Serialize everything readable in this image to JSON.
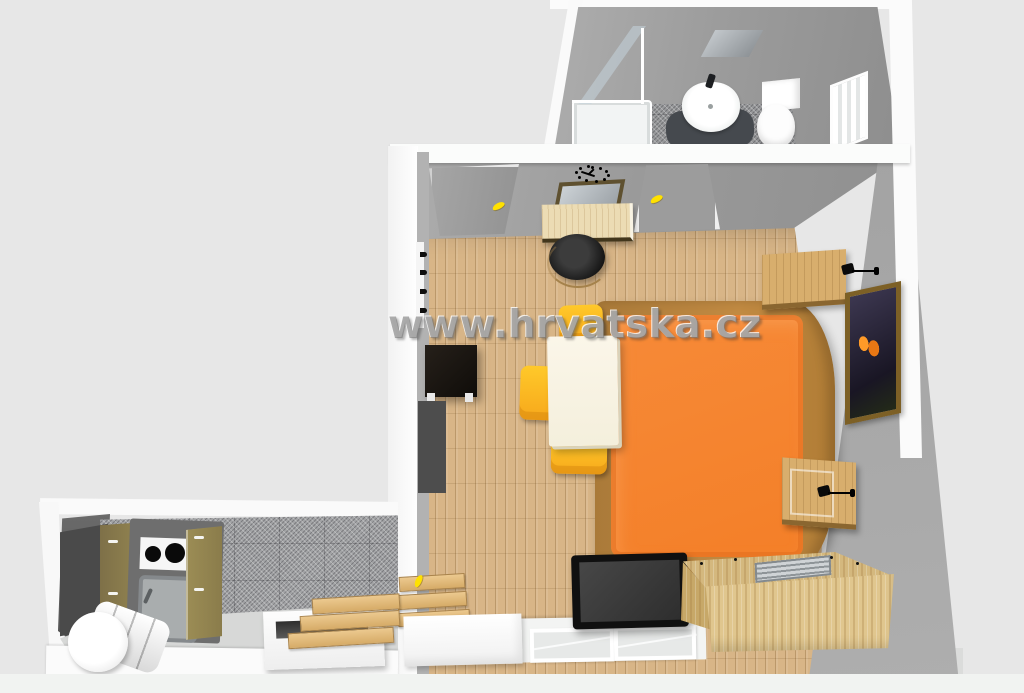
{
  "watermark": {
    "text": "www.hrvatska.cz"
  },
  "scene": {
    "type": "3d-apartment-floorplan-render",
    "view": "top-down perspective",
    "rooms": [
      {
        "name": "bathroom",
        "position": "top",
        "floor": "grey-speckled-tile",
        "fixtures": [
          "shower-cabin-glass",
          "shower-tray",
          "washbasin",
          "faucet",
          "dark-bath-mat",
          "toilet",
          "ceiling-mirror",
          "window"
        ]
      },
      {
        "name": "living-bedroom",
        "position": "center-right",
        "floor": "light-wood-parquet",
        "furniture": [
          "entry-door-grey-yellow-handle",
          "bathroom-door-grey-yellow-handle",
          "wall-clock-black",
          "leaning-mirror",
          "wood-desk",
          "black-stool",
          "coat-hooks",
          "cream-dining-table",
          "yellow-chair-top",
          "yellow-chair-left",
          "yellow-chair-bottom",
          "black-cube-cabinet",
          "dark-wall-panel",
          "orange-double-bed",
          "nightstand-with-wall-lamp-top",
          "nightstand-with-wall-lamp-bottom",
          "butterfly-picture",
          "tv-flatscreen",
          "wooden-chest-with-grille",
          "white-radiator-box",
          "window-bottom-1",
          "window-bottom-2",
          "wooden-step-planks",
          "kitchen-door-handle"
        ]
      },
      {
        "name": "kitchen",
        "position": "bottom-left",
        "floor": "grey-speckled-tile",
        "furniture": [
          "kitchen-unit-counter",
          "hob-two-burners",
          "grey-sink",
          "olive-cabinet-doors-left",
          "olive-cabinet-doors-right",
          "dark-slab",
          "water-heater-boiler",
          "white-storage-box",
          "wooden-step-planks"
        ]
      }
    ]
  },
  "colors": {
    "background": "#e7e7e7",
    "wall_white": "#fbfbfb",
    "wall_grey": "#9c9c9c",
    "wall_grey_dark": "#4e4e4e",
    "floor_wood": "#d8b587",
    "tile_grey": "#a2a3a5",
    "bed_orange": "#f68a38",
    "bed_frame_brown": "#bc8440",
    "chair_yellow": "#ffc92a",
    "table_cream": "#fbf6e9",
    "chest_wood": "#e0c68e",
    "cabinet_olive": "#90824f",
    "accent_handle_yellow": "#ffe100",
    "tv_black": "#101010",
    "mat_dark": "#45494e"
  }
}
